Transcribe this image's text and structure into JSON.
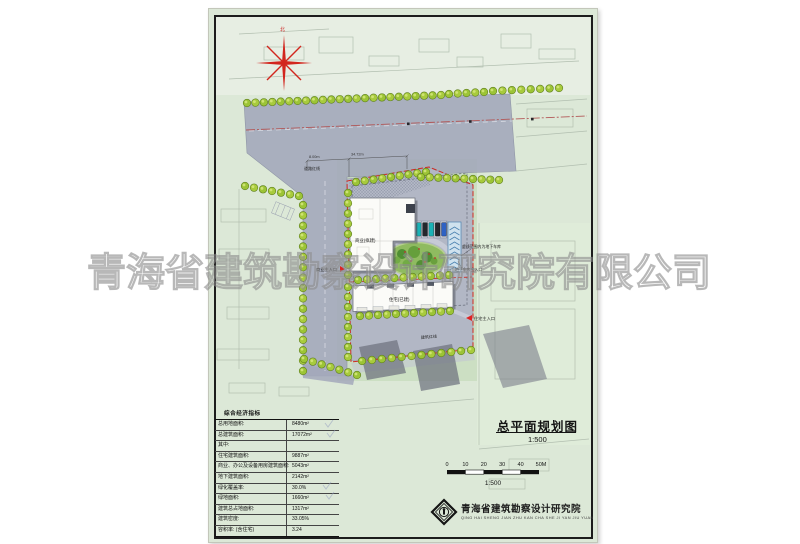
{
  "watermark": {
    "text": "青海省建筑勘察设计研究院有限公司"
  },
  "plan": {
    "north_label": "北",
    "labels": {
      "road_red_line": "道路红线",
      "building_red_line": "建筑红线",
      "commercial_building": "商业(拟建)",
      "residential_building": "住宅(已建)",
      "commercial_entrance": "商业主入口",
      "residential_entrance": "住宅主入口",
      "garage_note": "虚线范围内为地下车库",
      "garage_entrance": "地下车库出入口"
    },
    "dimensions": [
      "8.00m",
      "34.72m"
    ]
  },
  "economic_table": {
    "title": "综合经济指标",
    "rows": [
      {
        "label": "总用地面积:",
        "value": "8480m²"
      },
      {
        "label": "总建筑面积:",
        "value": "17072m²"
      },
      {
        "label": "其中:",
        "value": ""
      },
      {
        "label": "住宅建筑面积:",
        "value": "9887m²"
      },
      {
        "label": "商业、办公及设备用房建筑面积:",
        "value": "5043m²"
      },
      {
        "label": "地下建筑面积:",
        "value": "2142m²"
      },
      {
        "label": "绿化覆盖率:",
        "value": "30.0%"
      },
      {
        "label": "绿地面积:",
        "value": "1660m²"
      },
      {
        "label": "建筑总占地面积:",
        "value": "1317m²"
      },
      {
        "label": "建筑密度:",
        "value": "33.05%"
      },
      {
        "label": "容积率: (含住宅)",
        "value": "3.24"
      }
    ]
  },
  "title_block": {
    "title": "总平面规划图",
    "scale": "1:500"
  },
  "scale_bar": {
    "ticks": [
      "0",
      "10",
      "20",
      "30",
      "40",
      "50M"
    ],
    "label": "1:500"
  },
  "publisher": {
    "name": "青海省建筑勘察设计研究院",
    "pinyin": "QING HAI SHENG JIAN ZHU KAN CHA SHE JI YAN JIU YUAN"
  },
  "colors": {
    "sheet_green": "#dce8d7",
    "road_gray": "#a3a8bb",
    "boundary_red": "#cf2820",
    "tree_green": "#a3c839"
  }
}
